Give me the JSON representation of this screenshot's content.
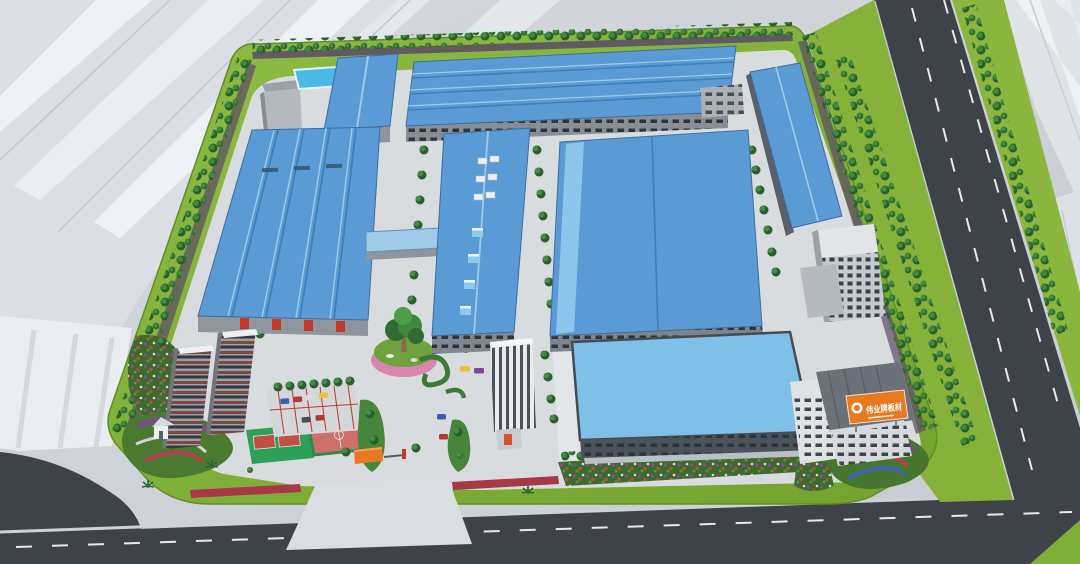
{
  "scene_title": "Factory campus aerial rendering",
  "billboard": {
    "text": "伟业牌板材",
    "background": "#e8791e",
    "text_color": "#ffffff"
  },
  "colors": {
    "roof_blue": "#5b9bd5",
    "roof_blue_light": "#7fc0e8",
    "roof_ridge": "#3f7fb8",
    "lawn_green": "#82b135",
    "road_asphalt": "#3e434a",
    "pavement": "#d9dcdf",
    "wall_gray": "#8e959c",
    "dark_wall": "#4a525a",
    "ghost_white": "#e3e7ec",
    "flower_purple": "#6d4b79",
    "flower_red": "#b03a4a",
    "flower_blue": "#3f63b0",
    "accent_orange": "#e8791e",
    "pool_blue": "#49b9e6",
    "court_green": "#2f9e57",
    "court_pink": "#cf6f6a",
    "dorm_brown": "#7c4a42"
  }
}
